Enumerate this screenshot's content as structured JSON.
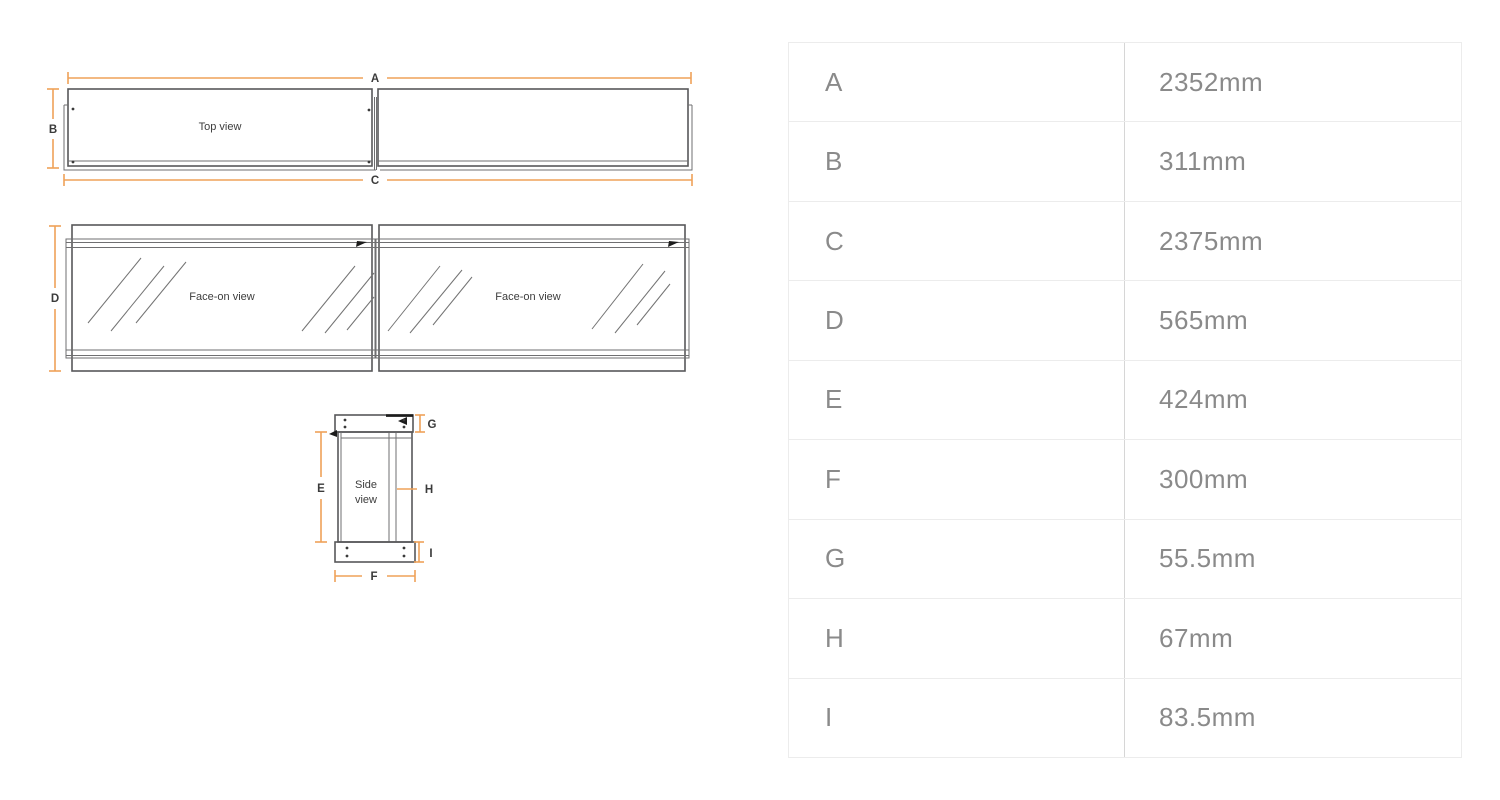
{
  "diagram": {
    "views": {
      "top_view_label": "Top view",
      "face_on_view_label": "Face-on view",
      "side_view_label_line1": "Side",
      "side_view_label_line2": "view"
    },
    "dimension_labels": {
      "a": "A",
      "b": "B",
      "c": "C",
      "d": "D",
      "e": "E",
      "f": "F",
      "g": "G",
      "h": "H",
      "i": "I"
    },
    "colors": {
      "dimension_line": "#EFA258",
      "drawing_line": "#58585A",
      "label_text": "#3B3B3B"
    }
  },
  "dimensions_table": {
    "rows": [
      {
        "label": "A",
        "value": "2352mm"
      },
      {
        "label": "B",
        "value": "311mm"
      },
      {
        "label": "C",
        "value": "2375mm"
      },
      {
        "label": "D",
        "value": "565mm"
      },
      {
        "label": "E",
        "value": "424mm"
      },
      {
        "label": "F",
        "value": "300mm"
      },
      {
        "label": "G",
        "value": "55.5mm"
      },
      {
        "label": "H",
        "value": "67mm"
      },
      {
        "label": "I",
        "value": "83.5mm"
      }
    ],
    "text_color": "#8A8A8A",
    "row_divider_color": "#ECECEC",
    "column_divider_color": "#D6D6D6"
  }
}
